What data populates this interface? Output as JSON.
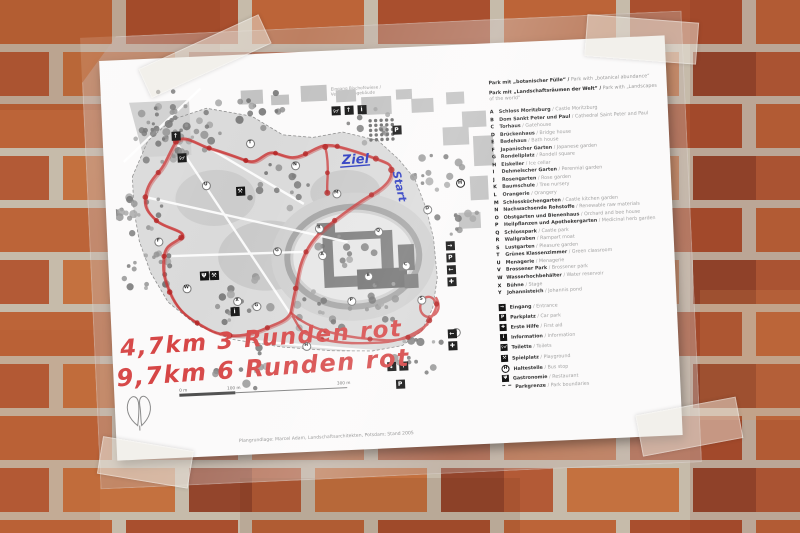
{
  "map_sheet": {
    "top_caption": [
      "Eingang Bischofswiese /",
      "Verwaltungsgebäude"
    ],
    "finish_label": "Ziel",
    "start_label": "Start",
    "route_notes": [
      "4,7km  3 Runden rot",
      "9,7km  6 Runden rot"
    ],
    "scale_labels": [
      "0 m",
      "100 m",
      "300 m"
    ],
    "credits": "Plangrundlage: Marcel Adam, Landschaftsarchitekten, Potsdam; Stand 2005",
    "colors": {
      "route_marker_red": "#c92f2f",
      "note_marker_red": "#d64545",
      "pen_blue": "#2838c0",
      "paper": "#fbfafa",
      "brick_orange": "#bc6438",
      "mortar": "#c6bbaa"
    },
    "legend": {
      "header": [
        {
          "de": "Park mit „botanischer Fülle“ /",
          "en": "Park with „botanical abundance“"
        },
        {
          "de": "Park mit „Landschaftsräumen der Welt“ /",
          "en": "Park with „Landscapes of the world“"
        }
      ],
      "items": [
        {
          "letter": "A",
          "de": "Schloss Moritzburg",
          "en": "Castle Moritzburg"
        },
        {
          "letter": "B",
          "de": "Dom Sankt Peter und Paul",
          "en": "Cathedral Saint Peter and Paul"
        },
        {
          "letter": "C",
          "de": "Torhaus",
          "en": "Gatehouse"
        },
        {
          "letter": "D",
          "de": "Brückenhaus",
          "en": "Bridge house"
        },
        {
          "letter": "E",
          "de": "Badehaus",
          "en": "Bath house"
        },
        {
          "letter": "F",
          "de": "Japanischer Garten",
          "en": "Japanese garden"
        },
        {
          "letter": "G",
          "de": "Rondellplatz",
          "en": "Rondell square"
        },
        {
          "letter": "H",
          "de": "Eiskeller",
          "en": "Ice cellar"
        },
        {
          "letter": "I",
          "de": "Dehmelscher Garten",
          "en": "Perennial garden"
        },
        {
          "letter": "J",
          "de": "Rosengarten",
          "en": "Rose garden"
        },
        {
          "letter": "K",
          "de": "Baumschule",
          "en": "Tree nursery"
        },
        {
          "letter": "L",
          "de": "Orangerie",
          "en": "Orangery"
        },
        {
          "letter": "M",
          "de": "Schlossküchengarten",
          "en": "Castle kitchen garden"
        },
        {
          "letter": "N",
          "de": "Nachwachsende Rohstoffe",
          "en": "Renewable raw materials"
        },
        {
          "letter": "O",
          "de": "Obstgarten und Bienenhaus",
          "en": "Orchard and bee house"
        },
        {
          "letter": "P",
          "de": "Heilpflanzen und Apothekergarten",
          "en": "Medicinal herb garden"
        },
        {
          "letter": "Q",
          "de": "Schlosspark",
          "en": "Castle park"
        },
        {
          "letter": "R",
          "de": "Wallgraben",
          "en": "Rampart moat"
        },
        {
          "letter": "S",
          "de": "Lustgarten",
          "en": "Pleasure garden"
        },
        {
          "letter": "T",
          "de": "Grünes Klassenzimmer",
          "en": "Green classroom"
        },
        {
          "letter": "U",
          "de": "Menagerie",
          "en": "Menagerie"
        },
        {
          "letter": "V",
          "de": "Brossener Park",
          "en": "Brossener park"
        },
        {
          "letter": "W",
          "de": "Wasserhochbehälter",
          "en": "Water reservoir"
        },
        {
          "letter": "X",
          "de": "Bühne",
          "en": "Stage"
        },
        {
          "letter": "Y",
          "de": "Johannisteich",
          "en": "Johannis pond"
        }
      ],
      "icons": [
        {
          "glyph": "arrow-right",
          "de": "Eingang",
          "en": "Entrance"
        },
        {
          "glyph": "parking",
          "de": "Parkplatz",
          "en": "Car park"
        },
        {
          "glyph": "first-aid",
          "de": "Erste Hilfe",
          "en": "First aid"
        },
        {
          "glyph": "information",
          "de": "Information",
          "en": "Information"
        },
        {
          "glyph": "toilet",
          "de": "Toilette",
          "en": "Toilets"
        },
        {
          "glyph": "playground",
          "de": "Spielplatz",
          "en": "Playground"
        },
        {
          "glyph": "bus-stop",
          "de": "Haltestelle",
          "en": "Bus stop"
        },
        {
          "glyph": "restaurant",
          "de": "Gastronomie",
          "en": "Restaurant"
        },
        {
          "glyph": "boundary",
          "de": "Parkgrenze",
          "en": "Park boundaries"
        }
      ]
    },
    "map_letters": [
      {
        "t": "T",
        "x": 136,
        "y": 66
      },
      {
        "t": "U",
        "x": 90,
        "y": 106
      },
      {
        "t": "V",
        "x": 93,
        "y": 196
      },
      {
        "t": "G",
        "x": 158,
        "y": 175
      },
      {
        "t": "R",
        "x": 201,
        "y": 154
      },
      {
        "t": "A",
        "x": 203,
        "y": 181
      },
      {
        "t": "B",
        "x": 248,
        "y": 204
      },
      {
        "t": "C",
        "x": 286,
        "y": 195
      },
      {
        "t": "D",
        "x": 310,
        "y": 140
      },
      {
        "t": "P",
        "x": 230,
        "y": 228
      },
      {
        "t": "G",
        "x": 135,
        "y": 229
      },
      {
        "t": "W",
        "x": 66,
        "y": 208
      },
      {
        "t": "X",
        "x": 116,
        "y": 223
      },
      {
        "t": "H",
        "x": 183,
        "y": 271
      },
      {
        "t": "L",
        "x": 333,
        "y": 264
      },
      {
        "t": "Q",
        "x": 260,
        "y": 160
      },
      {
        "t": "S",
        "x": 300,
        "y": 230
      },
      {
        "t": "F",
        "x": 40,
        "y": 160
      },
      {
        "t": "M",
        "x": 220,
        "y": 120
      },
      {
        "t": "N",
        "x": 180,
        "y": 90
      }
    ],
    "map_icons": [
      {
        "g": "↑",
        "x": 63,
        "y": 56
      },
      {
        "g": "♀♂",
        "x": 68,
        "y": 78
      },
      {
        "g": "♀♂",
        "x": 224,
        "y": 38
      },
      {
        "g": "↑",
        "x": 237,
        "y": 38
      },
      {
        "g": "i",
        "x": 250,
        "y": 38
      },
      {
        "g": "P",
        "x": 284,
        "y": 60
      },
      {
        "g": "H",
        "x": 345,
        "y": 116,
        "circle": true
      },
      {
        "g": "→",
        "x": 332,
        "y": 178
      },
      {
        "g": "P",
        "x": 332,
        "y": 190
      },
      {
        "g": "←",
        "x": 332,
        "y": 202
      },
      {
        "g": "✚",
        "x": 332,
        "y": 214
      },
      {
        "g": "←",
        "x": 330,
        "y": 266
      },
      {
        "g": "✚",
        "x": 330,
        "y": 278
      },
      {
        "g": "↓",
        "x": 268,
        "y": 296
      },
      {
        "g": "↑",
        "x": 280,
        "y": 296
      },
      {
        "g": "P",
        "x": 276,
        "y": 314
      },
      {
        "g": "⚒",
        "x": 125,
        "y": 114
      },
      {
        "g": "Ψ",
        "x": 85,
        "y": 197
      },
      {
        "g": "⚒",
        "x": 95,
        "y": 197
      },
      {
        "g": "i",
        "x": 114,
        "y": 234
      }
    ]
  }
}
